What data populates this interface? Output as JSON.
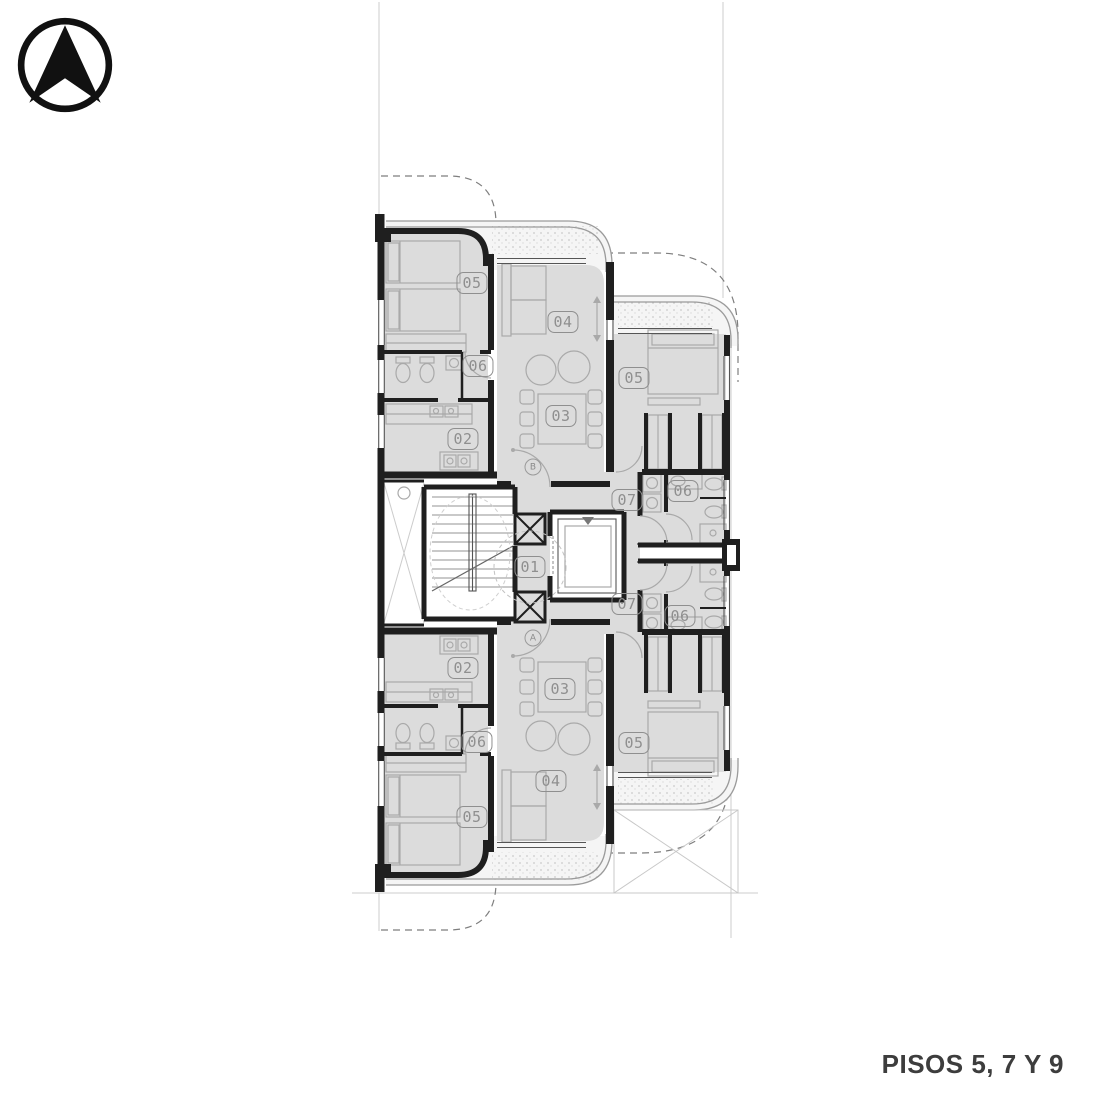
{
  "page": {
    "caption": "PISOS 5, 7 Y 9"
  },
  "colors": {
    "wall": "#1f1f1f",
    "room_fill": "#dcdcdc",
    "furniture": "#a9a9a9",
    "badge": "#8f8f8f",
    "lot_line": "#cccccc",
    "dash_line": "#7e7e7e",
    "rail": "#9b9b9b",
    "hatch": "#c8c8c8",
    "caption_color": "#3d3d3d"
  },
  "north_arrow": {
    "icon": "north-arrow-icon"
  },
  "plan": {
    "room_badges": [
      {
        "id": "01",
        "x": 530,
        "y": 567
      },
      {
        "id": "05",
        "x": 472,
        "y": 283
      },
      {
        "id": "04",
        "x": 563,
        "y": 322
      },
      {
        "id": "06",
        "x": 478,
        "y": 366
      },
      {
        "id": "03",
        "x": 561,
        "y": 416
      },
      {
        "id": "02",
        "x": 463,
        "y": 439
      },
      {
        "id": "05",
        "x": 634,
        "y": 378
      },
      {
        "id": "07",
        "x": 627,
        "y": 500
      },
      {
        "id": "06",
        "x": 683,
        "y": 491
      },
      {
        "id": "07",
        "x": 627,
        "y": 604
      },
      {
        "id": "06",
        "x": 680,
        "y": 616
      },
      {
        "id": "05",
        "x": 634,
        "y": 743
      },
      {
        "id": "02",
        "x": 463,
        "y": 668
      },
      {
        "id": "03",
        "x": 560,
        "y": 689
      },
      {
        "id": "06",
        "x": 477,
        "y": 742
      },
      {
        "id": "04",
        "x": 551,
        "y": 781
      },
      {
        "id": "05",
        "x": 472,
        "y": 817
      }
    ],
    "door_tags": [
      {
        "id": "B",
        "x": 533,
        "y": 467
      },
      {
        "id": "A",
        "x": 533,
        "y": 638
      }
    ]
  }
}
